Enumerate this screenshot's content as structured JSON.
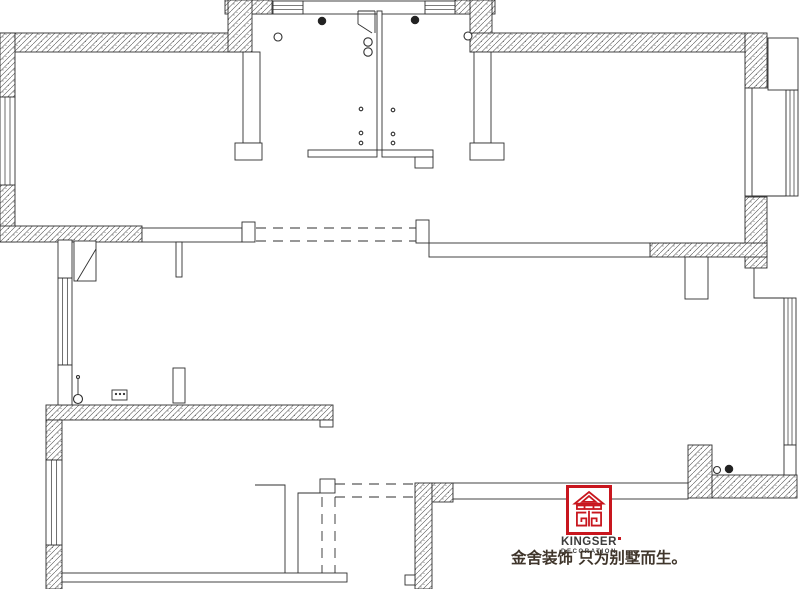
{
  "logo": {
    "brand": "KINGSER",
    "sub_brand": "DECORATION",
    "slogan": "金舍装饰 只为别墅而生。"
  },
  "colors": {
    "line": "#2f2f2f",
    "hatch_line": "#4a4a4a",
    "speckle": "#5a5a5a",
    "fill": "#ffffff",
    "logo_red": "#c8161e",
    "brand_text": "#3c3c3c",
    "slogan_text": "#3f352b"
  },
  "plan": {
    "underlay_boxes": [
      [
        250,
        1,
        230,
        13
      ]
    ],
    "hatched_walls": [
      [
        0,
        33,
        240,
        19
      ],
      [
        0,
        33,
        15,
        64
      ],
      [
        0,
        185,
        15,
        57
      ],
      [
        0,
        226,
        142,
        16
      ],
      [
        225,
        0,
        47,
        14
      ],
      [
        228,
        0,
        24,
        52
      ],
      [
        455,
        0,
        40,
        14
      ],
      [
        470,
        0,
        22,
        52
      ],
      [
        470,
        33,
        275,
        19
      ],
      [
        745,
        33,
        22,
        55
      ],
      [
        745,
        197,
        22,
        71
      ],
      [
        650,
        243,
        117,
        14
      ],
      [
        46,
        405,
        287,
        15
      ],
      [
        46,
        420,
        16,
        40
      ],
      [
        46,
        545,
        16,
        44
      ],
      [
        415,
        483,
        17,
        106
      ],
      [
        432,
        483,
        21,
        19
      ],
      [
        688,
        445,
        24,
        53
      ],
      [
        712,
        475,
        85,
        23
      ]
    ],
    "windows_vertical": [
      [
        0,
        97,
        15,
        88
      ],
      [
        58,
        278,
        14,
        87
      ],
      [
        46,
        460,
        16,
        85
      ],
      [
        786,
        90,
        12,
        106
      ],
      [
        784,
        298,
        12,
        147
      ]
    ],
    "windows_horizontal": [
      [
        273,
        1,
        30,
        13
      ],
      [
        425,
        1,
        30,
        13
      ]
    ],
    "solid_walls": [
      [
        243,
        52,
        17,
        91
      ],
      [
        235,
        143,
        27,
        17
      ],
      [
        474,
        52,
        17,
        91
      ],
      [
        470,
        143,
        34,
        17
      ],
      [
        377,
        11,
        5,
        139
      ],
      [
        308,
        150,
        69,
        7
      ],
      [
        382,
        150,
        51,
        7
      ],
      [
        415,
        157,
        18,
        11
      ],
      [
        142,
        228,
        100,
        14
      ],
      [
        242,
        222,
        13,
        20
      ],
      [
        176,
        242,
        6,
        35
      ],
      [
        173,
        368,
        12,
        35
      ],
      [
        429,
        243,
        221,
        14
      ],
      [
        685,
        257,
        23,
        42
      ],
      [
        58,
        240,
        14,
        38
      ],
      [
        58,
        365,
        14,
        40
      ],
      [
        453,
        483,
        235,
        16
      ],
      [
        416,
        220,
        13,
        23
      ]
    ],
    "boxes": [
      [
        768,
        38,
        30,
        52
      ],
      [
        745,
        88,
        7,
        108
      ],
      [
        784,
        445,
        12,
        30
      ],
      [
        320,
        479,
        15,
        14
      ],
      [
        405,
        575,
        10,
        10
      ],
      [
        62,
        573,
        285,
        9
      ],
      [
        320,
        420,
        13,
        7
      ],
      [
        112,
        390,
        15,
        10
      ],
      [
        74,
        241,
        22,
        40
      ]
    ],
    "lines": [
      [
        752,
        196,
        786,
        196
      ],
      [
        96,
        249,
        77,
        281
      ],
      [
        358,
        11,
        375,
        11
      ],
      [
        358,
        11,
        358,
        24
      ],
      [
        375,
        11,
        375,
        33
      ],
      [
        358,
        24,
        372,
        33
      ],
      [
        78,
        379,
        78,
        395
      ]
    ],
    "polylines": [
      [
        285,
        573,
        285,
        485,
        255,
        485
      ],
      [
        298,
        573,
        298,
        493,
        320,
        493
      ],
      [
        754,
        268,
        754,
        298,
        784,
        298
      ]
    ],
    "dashed_lines": [
      [
        256,
        228,
        416,
        228
      ],
      [
        256,
        241,
        416,
        241
      ],
      [
        335,
        484,
        415,
        484
      ],
      [
        335,
        497,
        415,
        497
      ],
      [
        322,
        497,
        322,
        573
      ],
      [
        335,
        497,
        335,
        573
      ]
    ],
    "circles": [
      [
        278,
        37,
        4,
        0
      ],
      [
        322,
        21,
        4,
        1
      ],
      [
        415,
        20,
        4,
        1
      ],
      [
        468,
        36,
        4,
        0
      ],
      [
        368,
        42,
        4.2,
        0
      ],
      [
        368,
        52,
        4.2,
        0
      ],
      [
        361,
        109,
        1.8,
        0
      ],
      [
        361,
        133,
        1.8,
        0
      ],
      [
        361,
        143,
        1.8,
        0
      ],
      [
        393,
        110,
        1.8,
        0
      ],
      [
        393,
        134,
        1.8,
        0
      ],
      [
        393,
        143,
        1.8,
        0
      ],
      [
        717,
        470,
        3.5,
        0
      ],
      [
        729,
        469,
        4,
        1
      ],
      [
        78,
        377,
        1.5,
        0
      ],
      [
        78,
        399,
        4.5,
        0
      ],
      [
        116,
        394,
        0.9,
        1
      ],
      [
        120,
        394,
        0.9,
        1
      ],
      [
        124,
        394,
        0.9,
        1
      ]
    ]
  }
}
